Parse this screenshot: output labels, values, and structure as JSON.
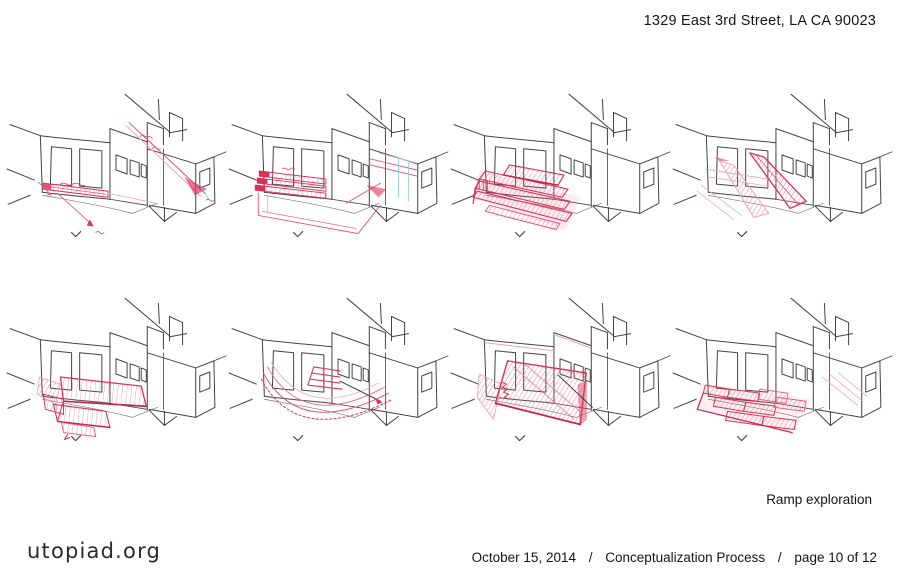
{
  "header": {
    "address": "1329 East 3rd Street, LA CA 90023"
  },
  "caption": {
    "text": "Ramp exploration"
  },
  "footer": {
    "brand": "utopiad.org",
    "date": "October 15, 2014",
    "separator": "/",
    "process": "Conceptualization Process",
    "page_indicator": "page 10 of 12"
  },
  "colors": {
    "paper": "#ffffff",
    "ink": "#45453f",
    "annotation_red": "#dd3459",
    "annotation_pink": "#f2a4b9",
    "pencil_cyan": "#8fd0da"
  },
  "sketches": [
    {
      "id": "sketch-1",
      "name": "ramp-along-left-wall-with-dimension-arrows"
    },
    {
      "id": "sketch-2",
      "name": "stacked-wall-ramps-with-floor-outline"
    },
    {
      "id": "sketch-3",
      "name": "switchback-parallel-ramps"
    },
    {
      "id": "sketch-4",
      "name": "two-diagonal-entry-ramps"
    },
    {
      "id": "sketch-5",
      "name": "stepped-platform-ramp"
    },
    {
      "id": "sketch-6",
      "name": "curved-sweeping-ramp"
    },
    {
      "id": "sketch-7",
      "name": "full-width-inclined-plane"
    },
    {
      "id": "sketch-8",
      "name": "terraced-zigzag-ramps"
    }
  ]
}
